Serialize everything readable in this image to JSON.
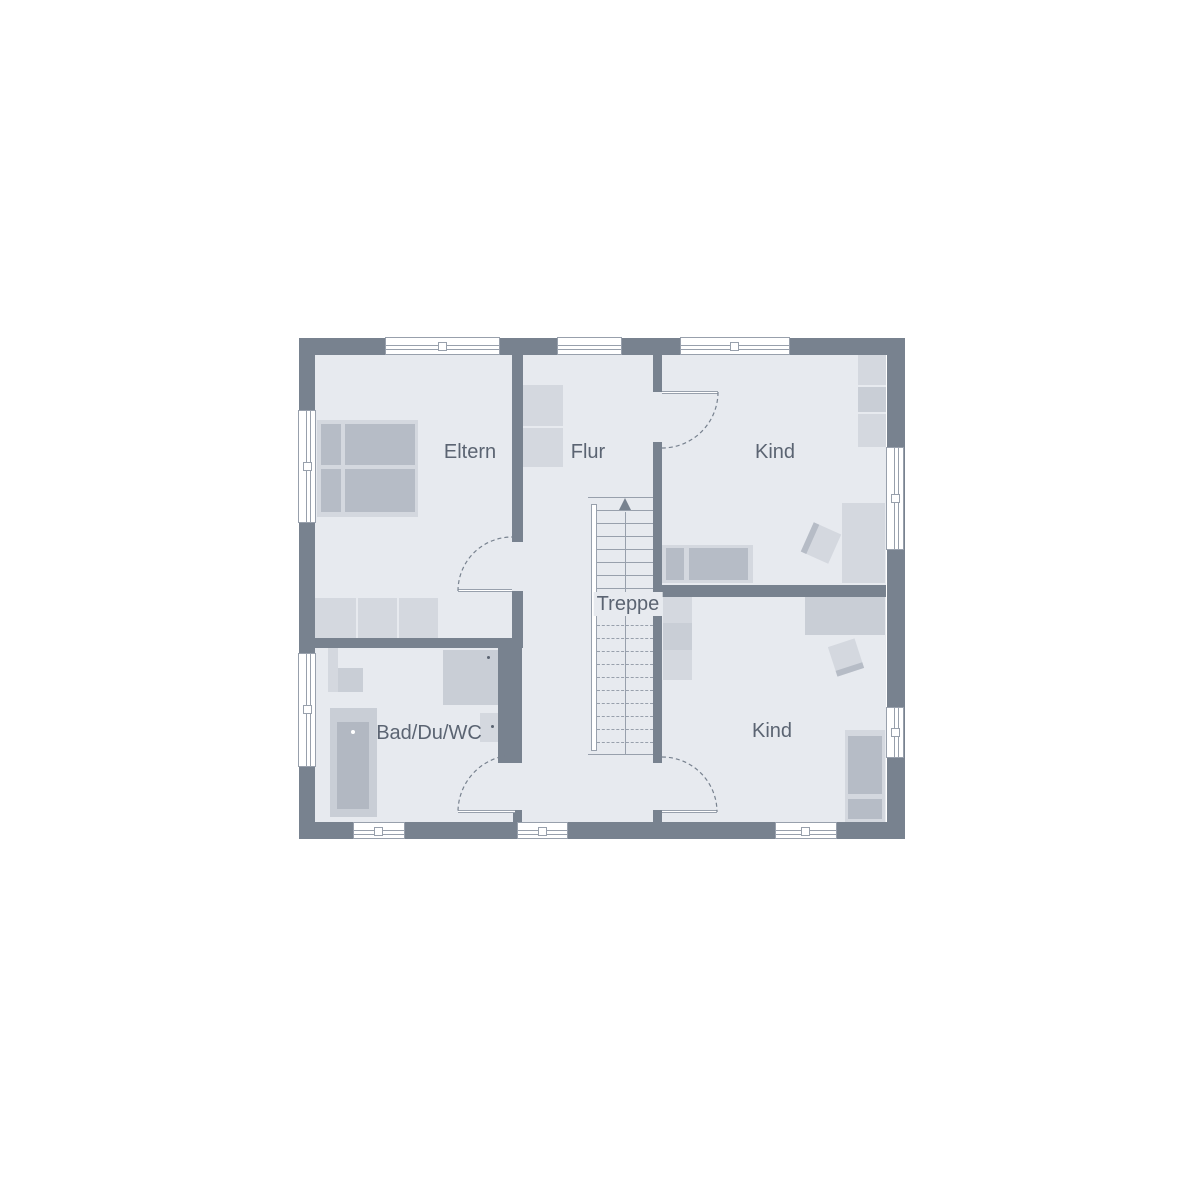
{
  "labels": {
    "eltern": "Eltern",
    "flur": "Flur",
    "kind_top": "Kind",
    "kind_bottom": "Kind",
    "treppe": "Treppe",
    "bad": "Bad/Du/WC"
  },
  "colors": {
    "wall": "#78828f",
    "floor": "#e7eaef",
    "furn_light": "#d4d8df",
    "furn_mid": "#c9ced6",
    "furn_dark": "#b6bcc6",
    "tub_inner": "#b2b8c2",
    "line": "#98a0ac",
    "text": "#5b6472",
    "window": "#ffffff",
    "background": "#ffffff"
  },
  "stairs": {
    "label": "Treppe",
    "direction": "up",
    "solid_treads": 7,
    "dashed_treads": 10
  }
}
